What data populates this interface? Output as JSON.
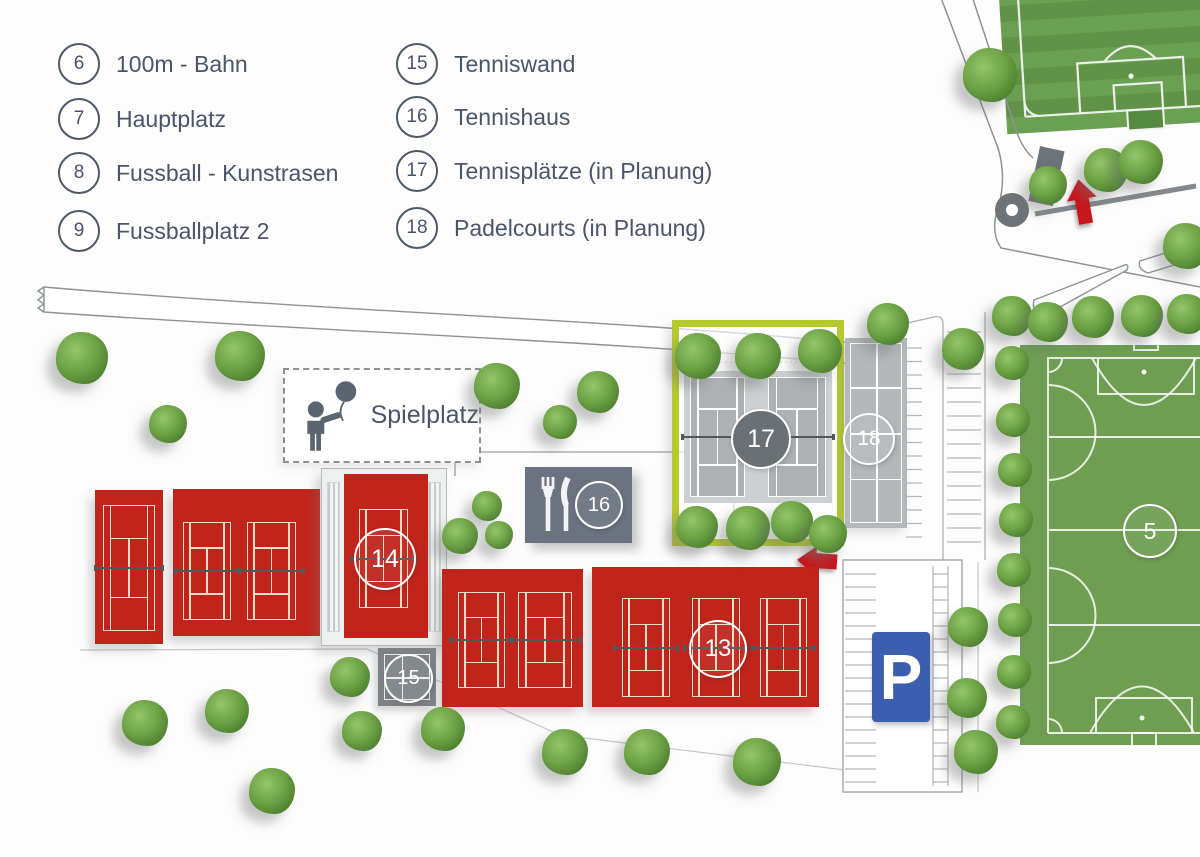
{
  "legend": {
    "items": [
      {
        "num": "6",
        "label": "100m - Bahn"
      },
      {
        "num": "7",
        "label": "Hauptplatz"
      },
      {
        "num": "8",
        "label": "Fussball - Kunstrasen"
      },
      {
        "num": "9",
        "label": "Fussballplatz 2"
      },
      {
        "num": "15",
        "label": "Tenniswand"
      },
      {
        "num": "16",
        "label": "Tennishaus"
      },
      {
        "num": "17",
        "label": "Tennisplätze (in Planung)"
      },
      {
        "num": "18",
        "label": "Padelcourts (in Planung)"
      }
    ]
  },
  "map": {
    "playground_label": "Spielplatz",
    "parking_label": "P",
    "badges": {
      "court5": "5",
      "court13": "13",
      "court14": "14",
      "wall15": "15",
      "house16": "16",
      "courts17": "17",
      "padel18": "18"
    },
    "colors": {
      "clay_red": "#c0241b",
      "field_green": "#6f9e53",
      "planned_gray": "#aeb2b5",
      "highlight_lime": "#b5c92f",
      "parking_blue": "#3b5fae",
      "arrow_red": "#c8141e"
    }
  }
}
